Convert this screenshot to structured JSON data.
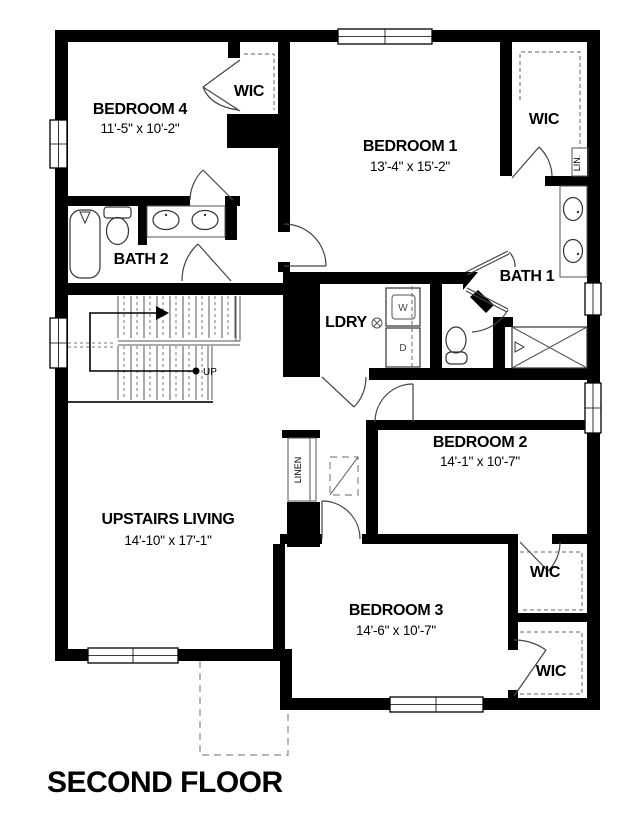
{
  "title": "SECOND FLOOR",
  "rooms": {
    "bedroom4": {
      "name": "BEDROOM 4",
      "dims": "11'-5\" x 10'-2\""
    },
    "bedroom1": {
      "name": "BEDROOM 1",
      "dims": "13'-4\" x 15'-2\""
    },
    "bedroom2": {
      "name": "BEDROOM 2",
      "dims": "14'-1\" x 10'-7\""
    },
    "bedroom3": {
      "name": "BEDROOM 3",
      "dims": "14'-6\" x 10'-7\""
    },
    "living": {
      "name": "UPSTAIRS LIVING",
      "dims": "14'-10\" x 17'-1\""
    },
    "bath1": {
      "name": "BATH 1"
    },
    "bath2": {
      "name": "BATH 2"
    },
    "laundry": {
      "name": "LDRY"
    }
  },
  "closets": {
    "wic_bedroom4": "WIC",
    "wic_bedroom1": "WIC",
    "wic_bedroom2": "WIC",
    "wic_bedroom3": "WIC",
    "linen_hall": "LINEN",
    "linen_bath": "LIN."
  },
  "stairs": {
    "direction_label": "UP"
  },
  "appliances": {
    "washer": "W",
    "dryer": "D"
  }
}
